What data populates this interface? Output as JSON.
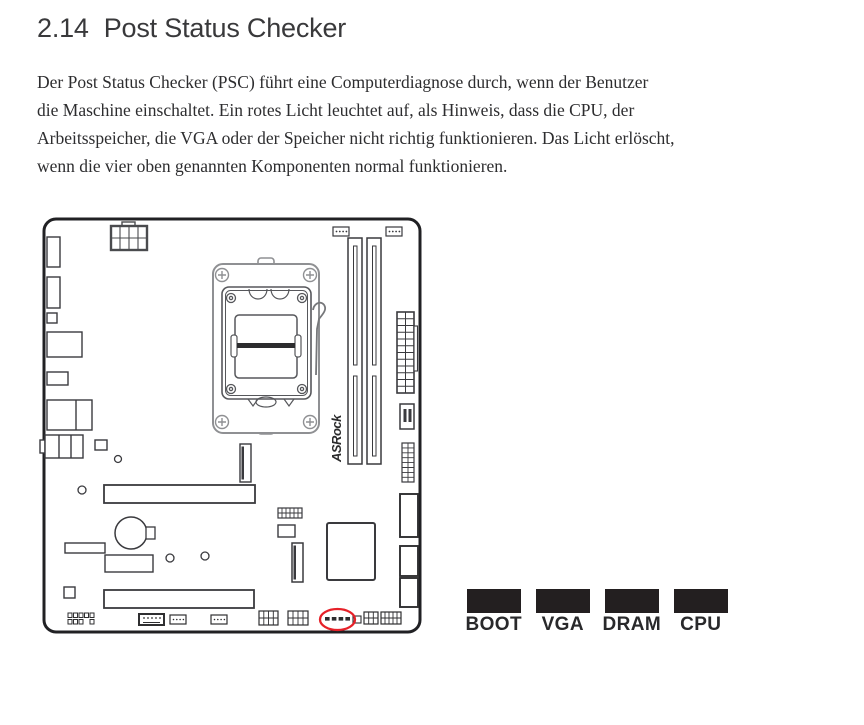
{
  "heading": {
    "number": "2.14",
    "title": "Post Status Checker"
  },
  "intro": {
    "lines": [
      "Der Post Status Checker (PSC) führt eine Computerdiagnose durch, wenn der Benutzer",
      "die Maschine einschaltet. Ein rotes Licht leuchtet auf, als Hinweis, dass die CPU, der",
      "Arbeitsspeicher, die VGA oder der Speicher nicht richtig funktionieren. Das Licht erlöscht,",
      "wenn die vier oben genannten Komponenten normal funktionieren."
    ]
  },
  "diagram": {
    "brand": "ASRock",
    "highlight_color": "#e62129",
    "board_line_color": "#212124"
  },
  "legend": {
    "box_color": "#231f20",
    "items": [
      {
        "label": "BOOT"
      },
      {
        "label": "VGA"
      },
      {
        "label": "DRAM"
      },
      {
        "label": "CPU"
      }
    ]
  }
}
